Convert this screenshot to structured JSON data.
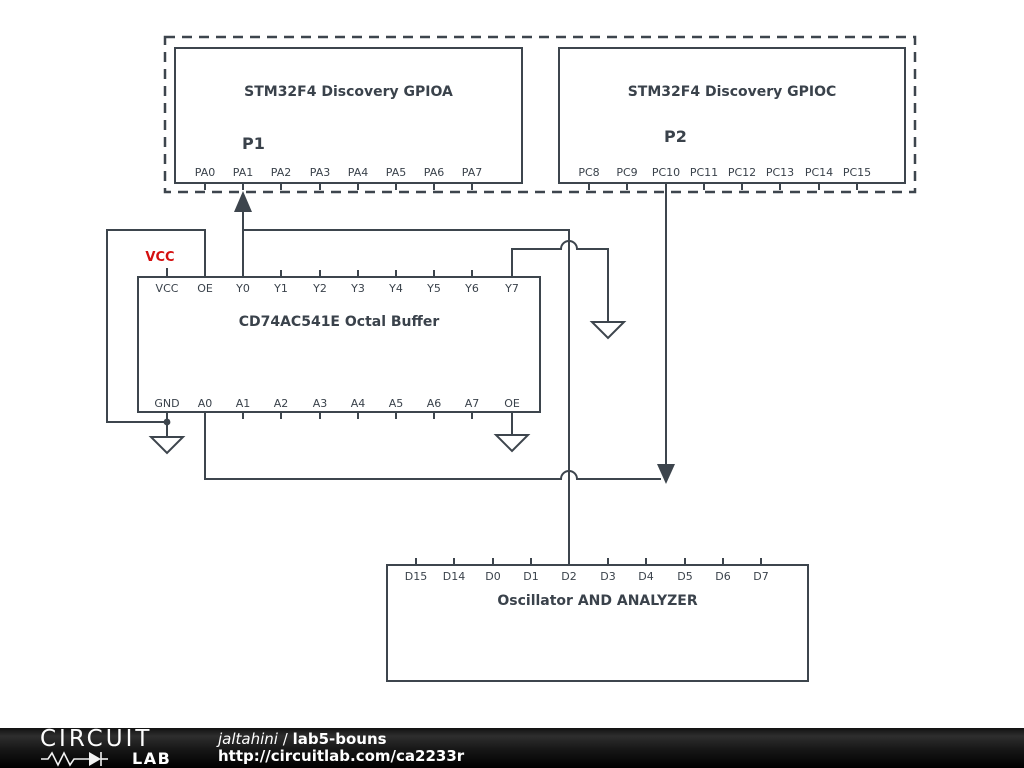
{
  "colors": {
    "wire": "#3d454d",
    "text": "#3a424b",
    "net_red": "#d40f0f",
    "footer_bg": "#000000",
    "footer_text": "#ffffff"
  },
  "gpioa": {
    "title": "STM32F4 Discovery GPIOA",
    "ref": "P1",
    "pins": [
      "PA0",
      "PA1",
      "PA2",
      "PA3",
      "PA4",
      "PA5",
      "PA6",
      "PA7"
    ]
  },
  "gpioc": {
    "title": "STM32F4 Discovery GPIOC",
    "ref": "P2",
    "pins": [
      "PC8",
      "PC9",
      "PC10",
      "PC11",
      "PC12",
      "PC13",
      "PC14",
      "PC15"
    ]
  },
  "buffer": {
    "title": "CD74AC541E Octal Buffer",
    "net_label": "VCC",
    "top_pins": [
      "VCC",
      "OE",
      "Y0",
      "Y1",
      "Y2",
      "Y3",
      "Y4",
      "Y5",
      "Y6",
      "Y7"
    ],
    "bottom_pins": [
      "GND",
      "A0",
      "A1",
      "A2",
      "A3",
      "A4",
      "A5",
      "A6",
      "A7",
      "OE"
    ]
  },
  "oscillator": {
    "title": "Oscillator AND ANALYZER",
    "pins": [
      "D15",
      "D14",
      "D0",
      "D1",
      "D2",
      "D3",
      "D4",
      "D5",
      "D6",
      "D7"
    ]
  },
  "footer": {
    "logo_top": "CIRCUIT",
    "logo_bottom": "LAB",
    "username": "jaltahini",
    "separator": "/",
    "project": "lab5-bouns",
    "url": "http://circuitlab.com/ca2233r"
  }
}
